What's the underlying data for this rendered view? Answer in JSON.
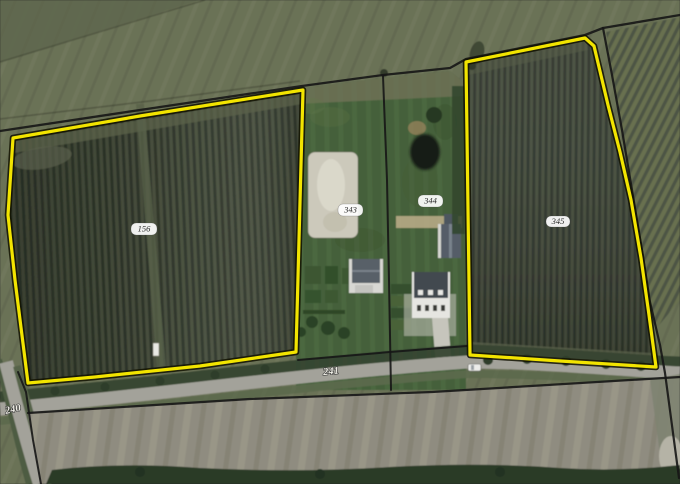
{
  "map": {
    "description": "Aerial photograph with cadastral parcel boundaries, two orchard parcels highlighted in yellow",
    "colors": {
      "highlight": "#f2e400",
      "cadastral_line": "#161616",
      "label_background": "#ffffff",
      "label_text": "#2b2b2b",
      "road_label_text": "#efeee6"
    },
    "parcels": {
      "p156": {
        "label": "156",
        "highlighted": true
      },
      "p343": {
        "label": "343",
        "highlighted": false
      },
      "p344": {
        "label": "344",
        "highlighted": false
      },
      "p345": {
        "label": "345",
        "highlighted": true
      },
      "p241": {
        "label": "241",
        "highlighted": false
      },
      "p240": {
        "label": "240",
        "highlighted": false
      }
    }
  }
}
